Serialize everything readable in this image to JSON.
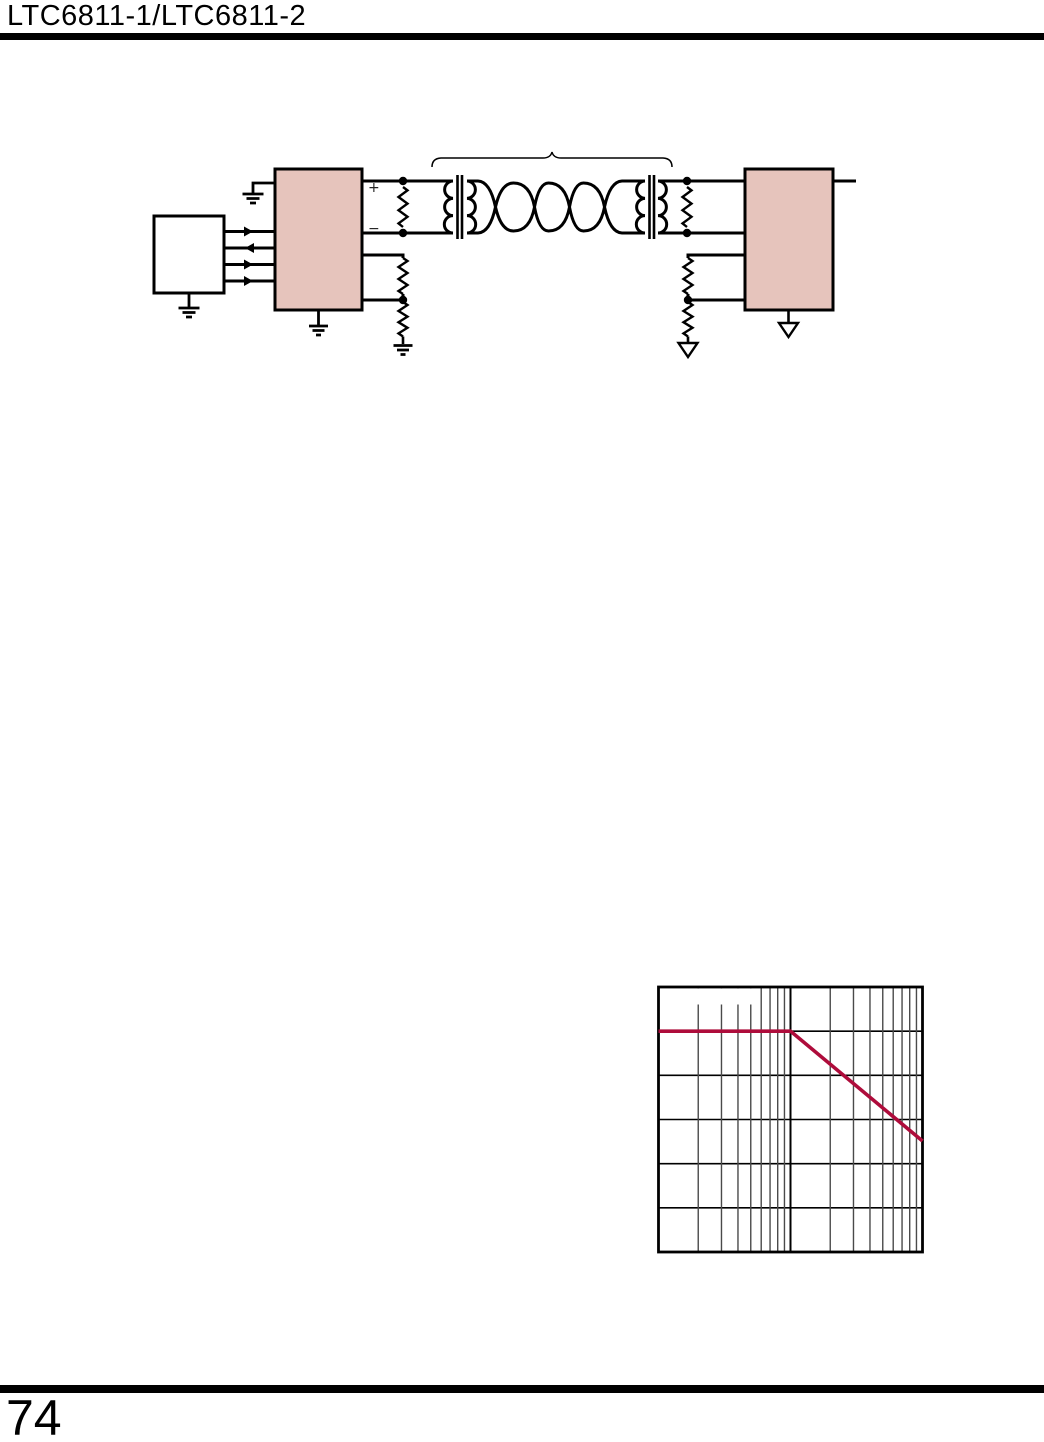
{
  "header": {
    "title": "LTC6811-1/LTC6811-2"
  },
  "footer": {
    "page_number": "74"
  },
  "circuit": {
    "plus_label": "+",
    "minus_label": "−",
    "colors": {
      "block_fill": "#e6c4bc",
      "line": "#000000"
    }
  },
  "chart_data": {
    "type": "line",
    "title": "",
    "xlabel": "",
    "ylabel": "",
    "grid": "on",
    "x_axis": {
      "scale": "log",
      "decades": 2,
      "tick_labels_visible": false
    },
    "y_axis": {
      "scale": "linear",
      "divisions": 6,
      "tick_labels_visible": false
    },
    "coordinates": "fraction_of_plot_area_from_top_left",
    "series": [
      {
        "name": "response-curve",
        "color": "#ae0c3b",
        "points": [
          [
            0,
            0.1667
          ],
          [
            0.5,
            0.1667
          ],
          [
            1.0,
            0.581
          ]
        ]
      }
    ],
    "frame_color": "#000000",
    "minor_grid_color": "#4a4a4a"
  }
}
